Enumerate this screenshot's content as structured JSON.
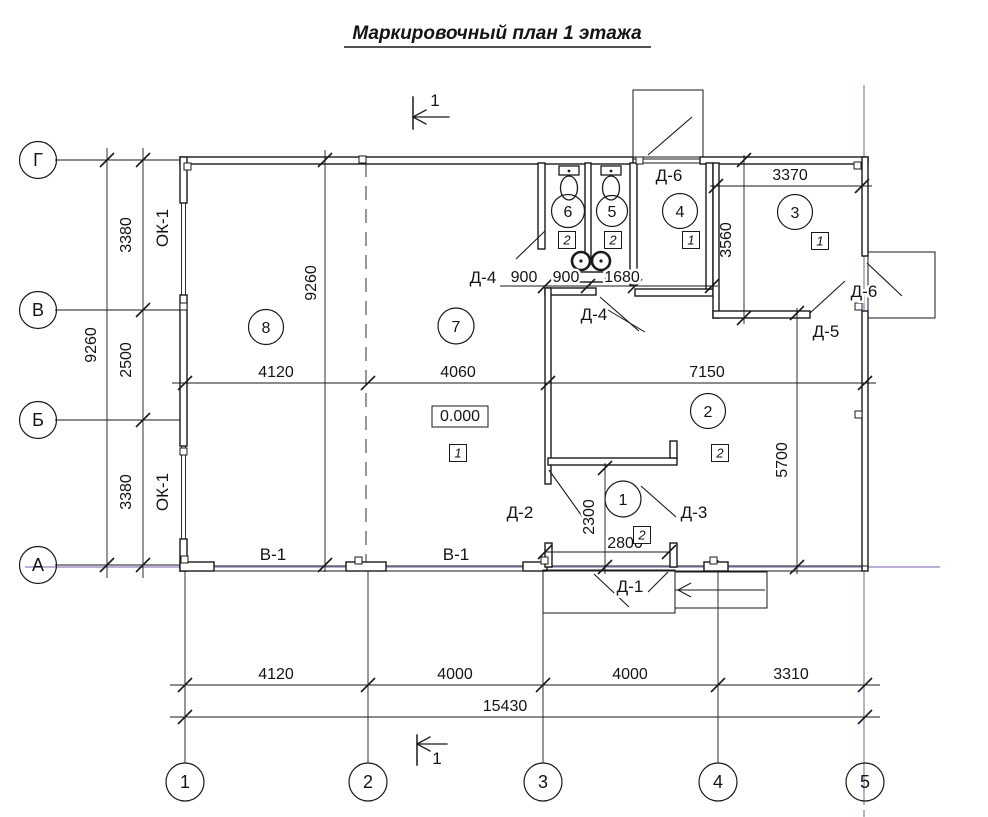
{
  "title": "Маркировочный план 1 этажа",
  "section": {
    "label": "1"
  },
  "axes_h": [
    "Г",
    "В",
    "Б",
    "А"
  ],
  "axes_v": [
    "1",
    "2",
    "3",
    "4",
    "5"
  ],
  "dims": {
    "left_3380_top": "3380",
    "left_2500": "2500",
    "left_3380_bot": "3380",
    "left_total_9260": "9260",
    "inner_9260": "9260",
    "mid_4120": "4120",
    "mid_4060": "4060",
    "mid_7150": "7150",
    "wc_900_a": "900",
    "wc_900_b": "900",
    "wc_1680": "1680",
    "room3_3370": "3370",
    "room3_3560": "3560",
    "room2_5700": "5700",
    "vest_2300": "2300",
    "vest_2800": "2800",
    "bot_4120": "4120",
    "bot_4000_a": "4000",
    "bot_4000_b": "4000",
    "bot_3310": "3310",
    "bot_total_15430": "15430"
  },
  "rooms": {
    "r1": "1",
    "r2": "2",
    "r3": "3",
    "r4": "4",
    "r5": "5",
    "r6": "6",
    "r7": "7",
    "r8": "8"
  },
  "floors": {
    "f_room6": "2",
    "f_room5": "2",
    "f_room4": "1",
    "f_room3": "1",
    "f_room7": "1",
    "f_room2": "2",
    "f_room1": "2"
  },
  "marks": {
    "door1": "Д-1",
    "door2": "Д-2",
    "door3": "Д-3",
    "door4_a": "Д-4",
    "door4_b": "Д-4",
    "door5": "Д-5",
    "door6_top": "Д-6",
    "door6_right": "Д-6",
    "window_ok1_top": "ОК-1",
    "window_ok1_bot": "ОК-1",
    "gate_v1_a": "В-1",
    "gate_v1_b": "В-1",
    "elevation": "0.000"
  },
  "colors": {
    "axis_highlight": "#b2a0d2",
    "ink": "#1a1a1a"
  }
}
